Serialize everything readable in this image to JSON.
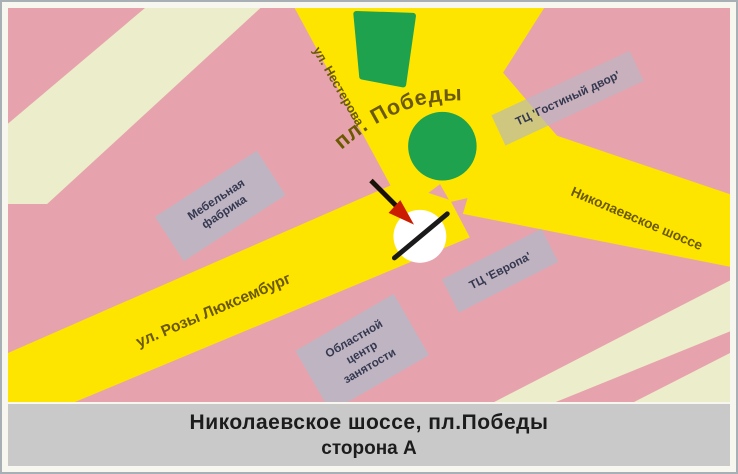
{
  "map": {
    "streets": {
      "nesterova": "ул. Нестерова",
      "pobedy_square": "пл. Победы",
      "nikolaevskoe": "Николаевское шоссе",
      "rozy_luxemburg": "ул. Розы Люксембург"
    },
    "buildings": {
      "furniture_factory_line1": "Мебельная",
      "furniture_factory_line2": "фабрика",
      "mall_gostiny_dvor": "ТЦ 'Гостиный двор'",
      "mall_evropa": "ТЦ 'Европа'",
      "regional_center_line1": "Областной",
      "regional_center_line2": "центр",
      "regional_center_line3": "занятости"
    },
    "colors": {
      "block_pink": "#e7a3ad",
      "road_yellow": "#fde500",
      "road_cream": "#ecedca",
      "park_green": "#1ea24d",
      "building_gray": "#b7b7c5",
      "street_label": "#6b5900",
      "arrow_red": "#cc1c00",
      "caption_bg": "#c9c9c9"
    }
  },
  "caption": {
    "line1": "Николаевское шоссе, пл.Победы",
    "line2": "сторона А"
  }
}
